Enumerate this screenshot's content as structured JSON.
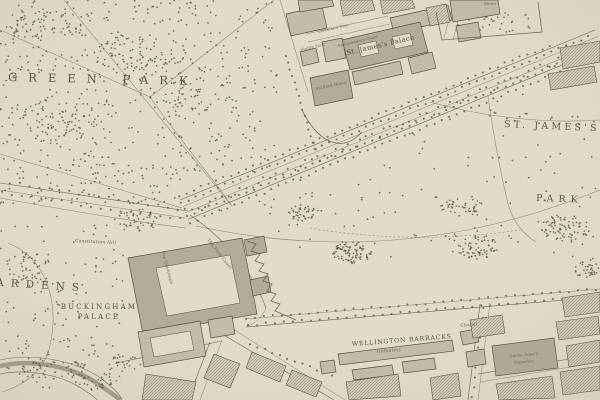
{
  "labels": {
    "green_park": "GREEN PARK",
    "st_jamess": "ST. JAMES'S",
    "park": "PARK",
    "buckingham": "BUCKINGHAM",
    "palace": "PALACE",
    "gardens_partial": "ARDENS",
    "wellington_barracks": "WELLINGTON BARRACKS",
    "infantry": "(Infantry)",
    "chapel": "Chapel",
    "st_james_palace": "St. James's Palace",
    "stafford_house": "Stafford House",
    "constitution_hill": "Constitution Hill",
    "fore_court": "The Fore Court",
    "quadrangle": "The Quadrangle",
    "mews": "Mews",
    "cleveland_row": "Cleveland Row",
    "stable_yard": "Stable Yard",
    "ambassadors_court": "Ambassadors Court",
    "queen_annes": "Queen Anne's",
    "mansions": "Mansions"
  },
  "palette": {
    "paper": "#eae4d4",
    "ink": "#4d4737",
    "line": "#8d8573",
    "building": "#c7c1b1",
    "building_dark": "#b6af9e",
    "dots": "#57513f",
    "water_bank": "#978f7b"
  },
  "map_art": {
    "scatters": [
      {
        "x": 0,
        "y": 0,
        "w": 278,
        "h": 172,
        "n": 480,
        "seed": 1
      },
      {
        "x": 0,
        "y": 172,
        "w": 182,
        "h": 32,
        "n": 70,
        "seed": 2
      },
      {
        "x": 210,
        "y": 110,
        "w": 388,
        "h": 150,
        "n": 150,
        "seed": 3,
        "clip": "park"
      },
      {
        "x": 0,
        "y": 215,
        "w": 125,
        "h": 140,
        "n": 85,
        "seed": 4
      },
      {
        "x": 0,
        "y": 340,
        "w": 105,
        "h": 48,
        "n": 28,
        "seed": 5
      },
      {
        "x": 380,
        "y": 60,
        "w": 200,
        "h": 60,
        "n": 40,
        "seed": 6,
        "clip": "park"
      }
    ],
    "clusters": [
      {
        "cx": 45,
        "cy": 25,
        "rx": 38,
        "ry": 16,
        "n": 60,
        "seed": 11
      },
      {
        "cx": 140,
        "cy": 55,
        "rx": 45,
        "ry": 22,
        "n": 80,
        "seed": 12
      },
      {
        "cx": 60,
        "cy": 120,
        "rx": 40,
        "ry": 25,
        "n": 70,
        "seed": 13
      },
      {
        "cx": 200,
        "cy": 92,
        "rx": 35,
        "ry": 25,
        "n": 50,
        "seed": 14
      },
      {
        "cx": 137,
        "cy": 220,
        "rx": 20,
        "ry": 13,
        "n": 45,
        "seed": 15
      },
      {
        "cx": 28,
        "cy": 268,
        "rx": 26,
        "ry": 16,
        "n": 50,
        "seed": 16
      },
      {
        "cx": 352,
        "cy": 252,
        "rx": 20,
        "ry": 12,
        "n": 90,
        "seed": 17
      },
      {
        "cx": 302,
        "cy": 213,
        "rx": 14,
        "ry": 8,
        "n": 40,
        "seed": 18
      },
      {
        "cx": 462,
        "cy": 207,
        "rx": 22,
        "ry": 9,
        "n": 45,
        "seed": 19
      },
      {
        "cx": 478,
        "cy": 247,
        "rx": 20,
        "ry": 12,
        "n": 65,
        "seed": 20
      },
      {
        "cx": 566,
        "cy": 228,
        "rx": 26,
        "ry": 13,
        "n": 80,
        "seed": 21
      },
      {
        "cx": 588,
        "cy": 268,
        "rx": 16,
        "ry": 10,
        "n": 35,
        "seed": 22
      },
      {
        "cx": 492,
        "cy": 22,
        "rx": 44,
        "ry": 12,
        "n": 38,
        "seed": 23
      },
      {
        "cx": 48,
        "cy": 368,
        "rx": 42,
        "ry": 10,
        "n": 55,
        "seed": 24
      },
      {
        "cx": 102,
        "cy": 382,
        "rx": 24,
        "ry": 9,
        "n": 32,
        "seed": 25
      },
      {
        "cx": 125,
        "cy": 365,
        "rx": 18,
        "ry": 10,
        "n": 25,
        "seed": 26
      }
    ],
    "rows": [
      {
        "x1": 179,
        "y1": 196,
        "x2": 556,
        "y2": 43,
        "spacing": 8,
        "jitter": 1.3,
        "seed": 31
      },
      {
        "x1": 181,
        "y1": 203,
        "x2": 594,
        "y2": 34,
        "spacing": 8,
        "jitter": 1.3,
        "seed": 32
      },
      {
        "x1": 187,
        "y1": 216,
        "x2": 600,
        "y2": 47,
        "spacing": 8,
        "jitter": 1.3,
        "seed": 33
      },
      {
        "x1": 190,
        "y1": 223,
        "x2": 600,
        "y2": 55,
        "spacing": 8,
        "jitter": 1.3,
        "seed": 34
      },
      {
        "x1": 186,
        "y1": 212,
        "x2": 600,
        "y2": 44,
        "spacing": 6.5,
        "jitter": 3.5,
        "seed": 35
      },
      {
        "x1": 246,
        "y1": 318,
        "x2": 600,
        "y2": 289,
        "spacing": 9,
        "jitter": 1,
        "seed": 36
      },
      {
        "x1": 248,
        "y1": 325,
        "x2": 600,
        "y2": 296,
        "spacing": 9,
        "jitter": 1,
        "seed": 37
      },
      {
        "x1": 0,
        "y1": 181,
        "x2": 186,
        "y2": 210,
        "spacing": 10,
        "jitter": 1.5,
        "seed": 38
      },
      {
        "x1": 2,
        "y1": 193,
        "x2": 186,
        "y2": 220,
        "spacing": 10,
        "jitter": 1.5,
        "seed": 39
      },
      {
        "x1": 250,
        "y1": 344,
        "x2": 338,
        "y2": 378,
        "spacing": 8,
        "jitter": 1,
        "seed": 40
      },
      {
        "x1": 484,
        "y1": 308,
        "x2": 472,
        "y2": 398,
        "spacing": 10,
        "jitter": 1,
        "seed": 41
      },
      {
        "x1": 286,
        "y1": 56,
        "x2": 318,
        "y2": 158,
        "spacing": 7,
        "jitter": 1,
        "seed": 42
      }
    ]
  }
}
